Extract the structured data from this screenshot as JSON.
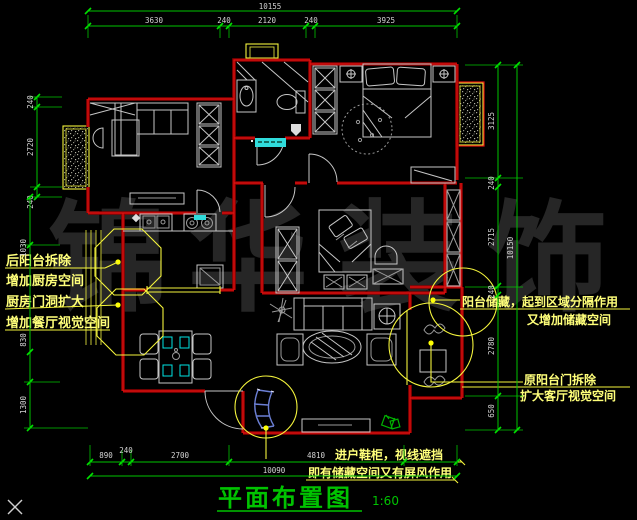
{
  "title": {
    "label": "平面布置图",
    "scale": "1:60"
  },
  "watermark": {
    "chars": [
      "锦",
      "华",
      "装",
      "饰"
    ]
  },
  "notes": {
    "kitchen": [
      "后阳台拆除",
      "增加厨房空间"
    ],
    "dining": [
      "厨房门洞扩大",
      "增加餐厅视觉空间"
    ],
    "balcony_storage": [
      "阳台储藏，起到区域分隔作用",
      "又增加储藏空间"
    ],
    "living_balcony": [
      "原阳台门拆除",
      "扩大客厅视觉空间"
    ],
    "entry": [
      "进户鞋柜，视线遮挡",
      "即有储藏空间又有屏风作用"
    ]
  },
  "dims": {
    "top": {
      "total": "10155",
      "segs": [
        "3630",
        "240",
        "2120",
        "240",
        "3925"
      ]
    },
    "left": {
      "segs": [
        "240",
        "2720",
        "240",
        "1030",
        "830",
        "1300"
      ]
    },
    "right": {
      "total": "10150",
      "segs": [
        "3125",
        "240",
        "2715",
        "240",
        "2780",
        "650"
      ]
    },
    "bottom": {
      "total": "10090",
      "segs": [
        "890",
        "240",
        "2700",
        "4810"
      ]
    }
  },
  "colors": {
    "background": "#000000",
    "wall_red": "#b40000",
    "dimension_green": "#00c300",
    "dimension_text": "#d4d4d4",
    "annotation_yellow": "#ffff7a",
    "furniture_gray": "#c6c6c6",
    "highlight_cyan": "#30dcdc",
    "cabinet_blue": "#6b7fd4",
    "title_green": "#00c300"
  }
}
